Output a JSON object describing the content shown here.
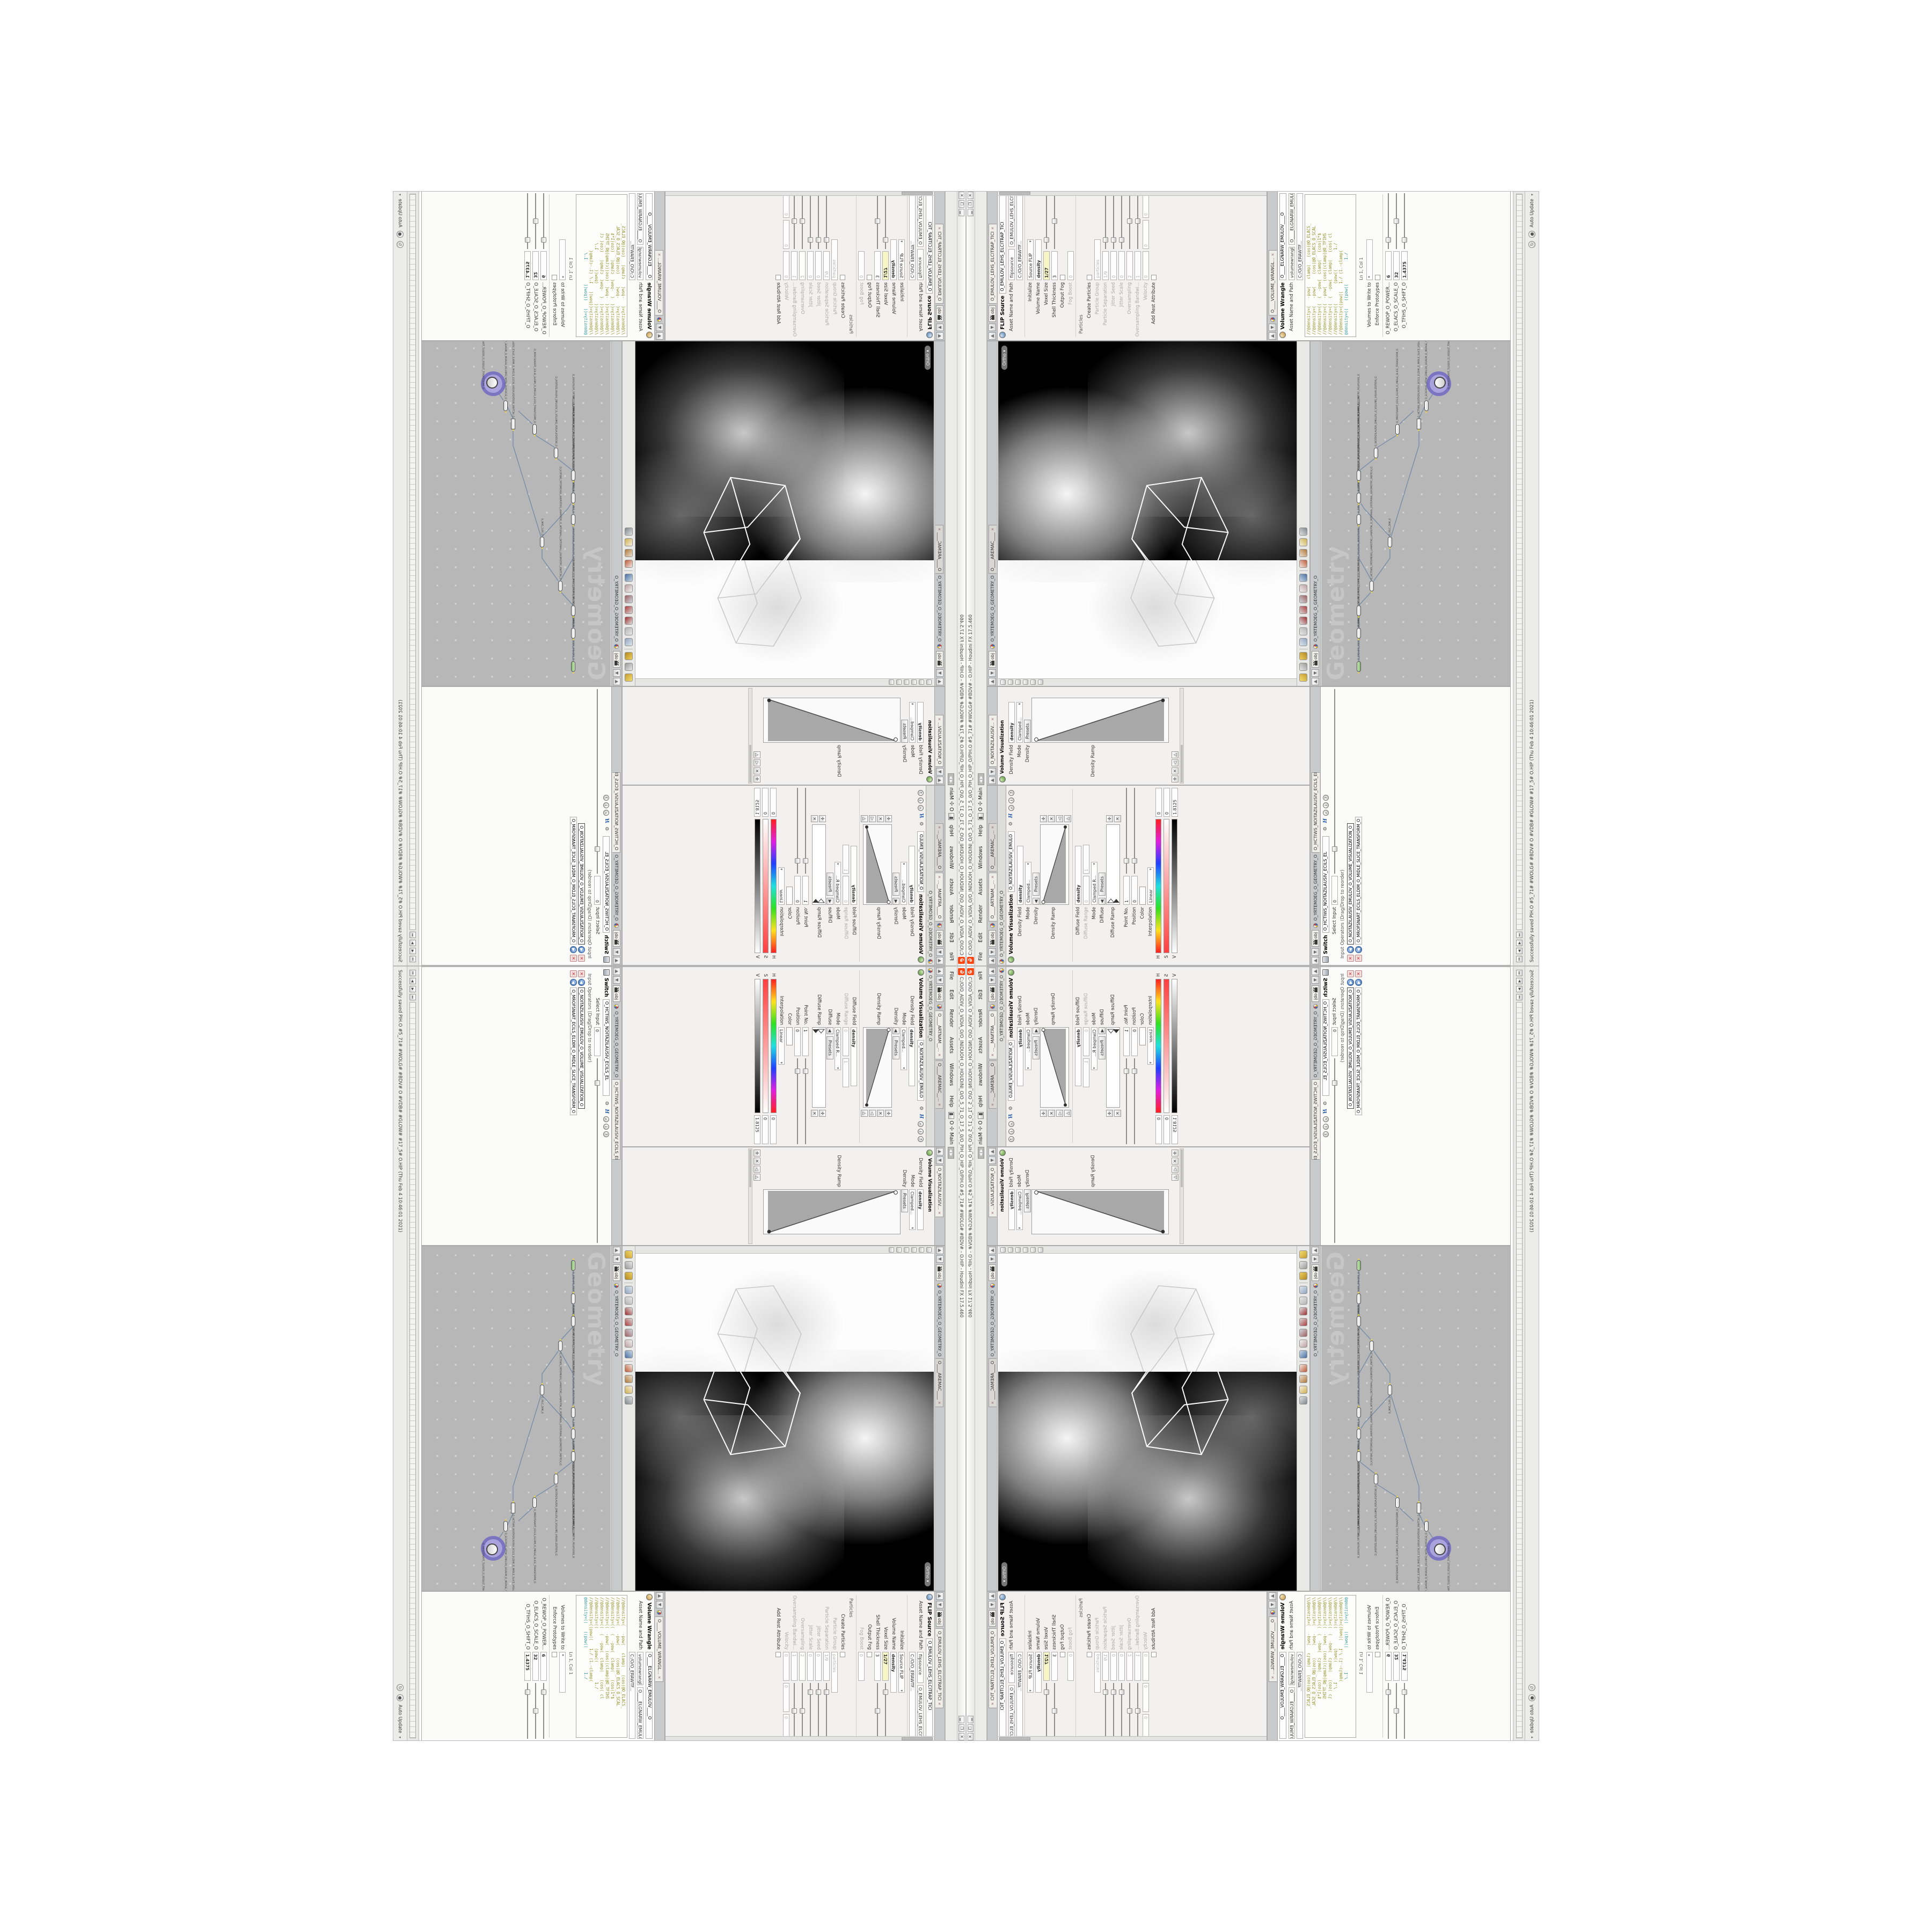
{
  "window": {
    "title": "C:/O/O_AIDIV_O_VIDIA_O/O_INIDUOH_O_HOUDINI_O/O_5_71_O_17_5_0/O_PIH_O_HIP_O/PIH.O  #5_71#  #WOLG# #BDV#   -   O.HIP - Houdini FX 17.5.460",
    "buttons": {
      "minimize": "▁",
      "maximize": "❐",
      "close": "✕"
    }
  },
  "menu": {
    "items": [
      "File",
      "Edit",
      "Render",
      "Assets",
      "Windows",
      "Help"
    ],
    "desktop_label": "O",
    "pane_label": "Main"
  },
  "colors": {
    "logo_orange": "#ff4713",
    "network_bg": "#b7b7b7",
    "selected_halo": "#7b74c0",
    "wire": "#7189a8",
    "yellow_field": "#f7f4c6",
    "code_olive": "#8f8f25",
    "code_teal": "#2d9898"
  },
  "panes": {
    "volviz_a": {
      "tabs": [
        "O____ARTNAM__...",
        "O____AREMAC__..."
      ],
      "breadcrumb": "O_YRTEMOEG_O_GEOMETRY_O",
      "title": "Volume Visualization",
      "node_field": "O_NOITAZILAUSIV_EMULO",
      "density_field_label": "Density Field",
      "density_field": "density",
      "mode_label": "Mode",
      "mode": "Clamped...",
      "density_label": "Density",
      "presets": "Presets",
      "density_ramp_label": "Density Ramp",
      "diffuse_field_label": "Diffuse Field",
      "diffuse_field": "density",
      "diffuse_range_label": "Diffuse Range",
      "diffuse_range_min": "0",
      "diffuse_range_max": "1",
      "mode2_label": "Mode",
      "mode2": "Clamped R...",
      "diffuse_label": "Diffuse",
      "diffuse_ramp_label": "Diffuse Ramp",
      "point_no_label": "Point No.",
      "point_no": "1",
      "position_label": "Position",
      "position": "0",
      "color_label": "Color",
      "interp_label": "Interpolation",
      "interp": "Linear",
      "h_label": "H",
      "h": "0",
      "s_label": "S",
      "s": "0",
      "v_label": "V",
      "v": "1.8125"
    },
    "volviz_b": {
      "tab": "O_NOITAZILAUSIV...",
      "title": "Volume Visualization",
      "node_field": "O_NOITAZILAUSIV_EMULO",
      "density_field_label": "Density Field",
      "density_field": "density",
      "mode_label": "Mode",
      "mode": "Clamped...",
      "density_label": "Density",
      "presets": "Presets",
      "density_ramp_label": "Density Ramp"
    },
    "viewport": {
      "tab": "O____AREMAC____",
      "objchip": "obj",
      "breadcrumb": "O_YRTEMOEG_O_GEOMETRY_O",
      "camera_pill": "Ortho ▾",
      "toolbar_icons": [
        "show-handles-icon",
        "shade-mode-icon",
        "material-icon",
        "separator",
        "view-pivot-icon",
        "camera-lock-icon",
        "transform-handle-icon",
        "rotate-handle-icon",
        "scale-handle-icon",
        "snap-cut-icon",
        "multiview-icon",
        "separator",
        "magnet-snap-icon",
        "hook-icon",
        "lasso-icon",
        "render-view-icon"
      ]
    },
    "network": {
      "objchip": "obj",
      "breadcrumb": "O_YRTEMOEG_O_GEOMETRY_O",
      "watermark": "Geometry",
      "nodes": [
        {
          "label": "an_CubeSphere",
          "name": "O_EREHPS_EBUC_O_CUBE_SPHERE_O"
        },
        {
          "label": "PolyWire",
          "name": "O_EMARFERIW_NOGYLOP_EREHPS_EBUC_O_CUBE_SPHERE_POLYGON_WIREFRAME_O"
        },
        {
          "label": "File",
          "name": "JBO.MD3-PETS_TREPILS_O_3DNIRG_O"
        },
        {
          "label": "Switch",
          "name": "O_HCTIWS_YRTEMOEG_LANRETXE_LANRETNI_O_INTERNAL_EXTERNAL_GEOMETRY_SWITCH_O"
        },
        {
          "label": "Clip",
          "name": "O_PILC_DIM_O"
        },
        {
          "label": "FLIP Source",
          "name": "O_EMULOV_LEHS_ELCITRAP_TICILPMI_DIULF_O_FLUID_IMPLICIT_PARTICLE_SHEL_VOLUME_O"
        },
        {
          "label": "VDB from Polygons",
          "name": "O_SNOGYLOP_YRTEMOEG_MORF_EMULOV_BDV_O_VDB_VOLUME_FROM_GEOMETRY_POLYGONS_O"
        },
        {
          "label": "Volume Wrangle",
          "name": "O____ELGNARW_EMULOV____O____VOLUME_WRANGLE____O2"
        },
        {
          "label": "Volume Visualization",
          "name": "O_NOITAZILAUSIV_EMULOV_O_VOLUME_VISUALIZATION_O"
        },
        {
          "label": "Transform",
          "name": "O_MROFSNART_ECILS_ELDIM_O_MIDLE_SLICE_TRANSFORM_O"
        },
        {
          "label": "Switch",
          "name": "O_HCTIWS_NOITAZILAUSIV_ECILS_ELDIM_O_MIDLE_SLICE_VISUALIZATION_SWITCH_O"
        },
        {
          "label": "Merge",
          "name": "O_ECAFRUS_HTIW_EMULOV_EGREM_O_MERGE_VOLUME_WITH_SURFACE_O"
        },
        {
          "label": "Transform",
          "name": "O_MROFSNART_TLUSER_O_RESULT_TRANSFORM_O"
        }
      ]
    },
    "switch": {
      "tab": "O_HCTIWS_NOITAZILAUSIV_ECILS_ELDIM_O_MIDLE_SLICE_VISUAL...",
      "breadcrumb": "O_YRTEMOEG_O_GEOMETRY_O",
      "title": "Switch",
      "node_field": "O_HCTIWS_NOITAZILAUSIV_ECILS_EL",
      "select_input_label": "Select Input",
      "select_input": "0",
      "list_label": "Input Operators (Drag/Drop to reorder)",
      "inputs": [
        "O_NOITAZILAUSIV_EMULOV_O_VOLUME_VISUALIZATION_O",
        "O_MROFSNART_ECILS_ELDIM_O_MIDLE_SLICE_TRANSFORM_O"
      ]
    },
    "flip": {
      "tab": "O_EMULOV_LEHS_ELCITRAP_TICI",
      "breadcrumb": "O_YRTEMOEG_O_GEOMETRY_O",
      "title": "FLIP Source",
      "node_field": "O_EMULOV_LEHS_ELCITRAP_TICI",
      "asset_label": "Asset Name and Path",
      "asset_name": "flipsource",
      "asset_node": "O_EMULOV_LEHS_ELCITRAP_TICI",
      "asset_path": "C:/O/O_ERAWTF...",
      "params": [
        {
          "label": "Initialize",
          "value": "Source FLIP"
        },
        {
          "label": "Volume Name",
          "value": "density"
        },
        {
          "label": "Voxel Size",
          "value": "1/27"
        },
        {
          "label": "Shell Thickness",
          "value": "3"
        },
        {
          "label": "Output Fog",
          "value": ""
        },
        {
          "label": "Fog Boost",
          "value": "0"
        }
      ],
      "particles_section": "Particles",
      "create_particles_label": "Create Particles",
      "particle_params": [
        {
          "label": "Particle Group",
          "value": "particles"
        },
        {
          "label": "Particle Separation",
          "value": "1/9"
        },
        {
          "label": "Jitter Seed",
          "value": "0"
        },
        {
          "label": "Jitter Scale",
          "value": "0"
        },
        {
          "label": "Oversampling",
          "value": "2"
        },
        {
          "label": "Oversampling Bandwi...",
          "value": "1"
        },
        {
          "label": "Velocity",
          "value": "0"
        }
      ],
      "add_rest_label": "Add Rest Attribute"
    },
    "wrangle": {
      "tab": "O____VOLUME_WRANGL...",
      "breadcrumb": "O_YRTEMOEG_O_GEOMETRY_O",
      "title": "Volume Wrangle",
      "node_field": "O____ELGNARW_EMULOV____O",
      "asset_label": "Asset Name and Path",
      "asset_name": "volumewrangle",
      "asset_node": "O____ELGNARW_EMULOV____O",
      "asset_path": "C:/O/O_ERAWTF...",
      "code": [
        "//@density=(   -pow(   clamp(   (cos(@O_ELACS_",
        "//@density=(   -pow(     (cos(@O_ELACS_O_SCAL",
        "//@density=((  (  -pow(  clamp(   (cos(1*$",
        "//@density=((  -pow(  (cos((clamp(@O_TFIHS",
        "//@density=((  (  -pow(  clamp(   (cos( cl",
        "//@density=((        (pow((        1./",
        "//@density=((pow((   1./ (1.-clamp(",
        "@density=((   ((pow((          1./"
      ],
      "cursor_pos": "Ln 1, Col 1",
      "volumes_label": "Volumes to Write to",
      "volumes_value": "*",
      "enforce_label": "Enforce Prototypes",
      "params": [
        {
          "label": "O_REWOP_O_POWER...",
          "value": "6"
        },
        {
          "label": "O_ELACS_O_SCALE_O",
          "value": "32"
        },
        {
          "label": "O_TFIHS_O_SHIFT_O",
          "value": "1.4375"
        }
      ]
    }
  },
  "statusbar": {
    "message": "Successfully saved PIH.O  #5_71#  #WOLG# #BDV#  O  #VDB# #GLOW#  #17_5#  O.HIP (Thu Feb 4 10:46:01 2021)",
    "cook_mode": "Auto Update"
  }
}
